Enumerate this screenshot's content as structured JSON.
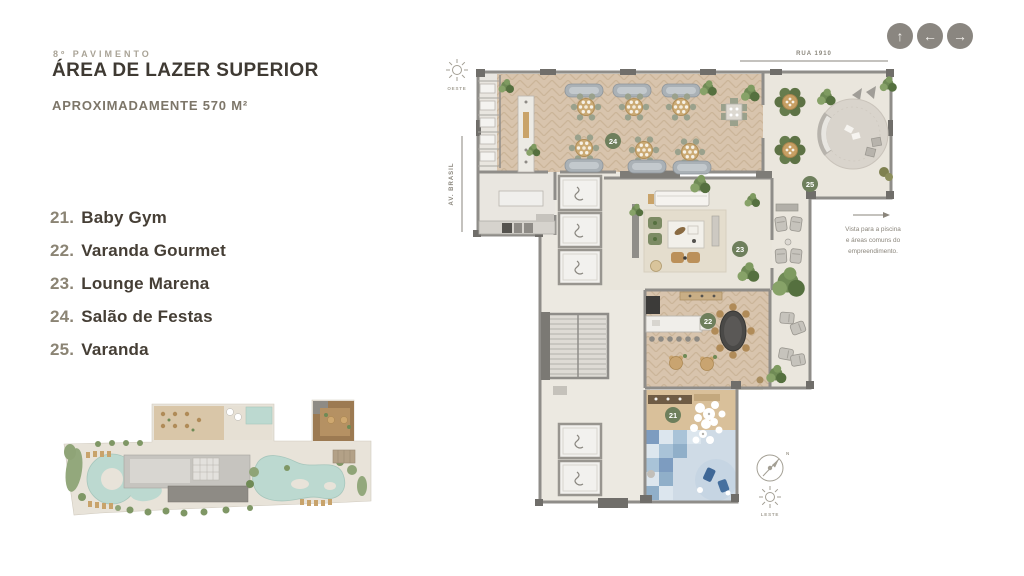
{
  "page": {
    "floor_label": "8º PAVIMENTO",
    "title": "ÁREA DE LAZER SUPERIOR",
    "area_label": "APROXIMADAMENTE 570 M²"
  },
  "legend": {
    "items": [
      {
        "number": "21.",
        "name": "Baby Gym"
      },
      {
        "number": "22.",
        "name": "Varanda Gourmet"
      },
      {
        "number": "23.",
        "name": "Lounge Marena"
      },
      {
        "number": "24.",
        "name": "Salão de Festas"
      },
      {
        "number": "25.",
        "name": "Varanda"
      }
    ]
  },
  "nav": {
    "up": "↑",
    "left": "←",
    "right": "→"
  },
  "plan": {
    "street_top": "RUA 1910",
    "street_left": "AV. BRASIL",
    "sun_west": "OESTE",
    "sun_east": "LESTE",
    "compass_north": "N",
    "view_note_lines": [
      "Vista para a piscina",
      "e áreas comuns do",
      "empreendimento."
    ],
    "badges": [
      {
        "n": "24"
      },
      {
        "n": "25"
      },
      {
        "n": "23"
      },
      {
        "n": "22"
      },
      {
        "n": "21"
      }
    ],
    "colors": {
      "badge_green": "#6e7f5c",
      "wall_gray": "#8f8d89",
      "wood_floor": "#d8c4ad",
      "terrace_floor": "#eae6dd",
      "baby_gym_blue": "#7d9cc0",
      "text_dark": "#3f3a33",
      "text_muted": "#8a8375"
    }
  }
}
